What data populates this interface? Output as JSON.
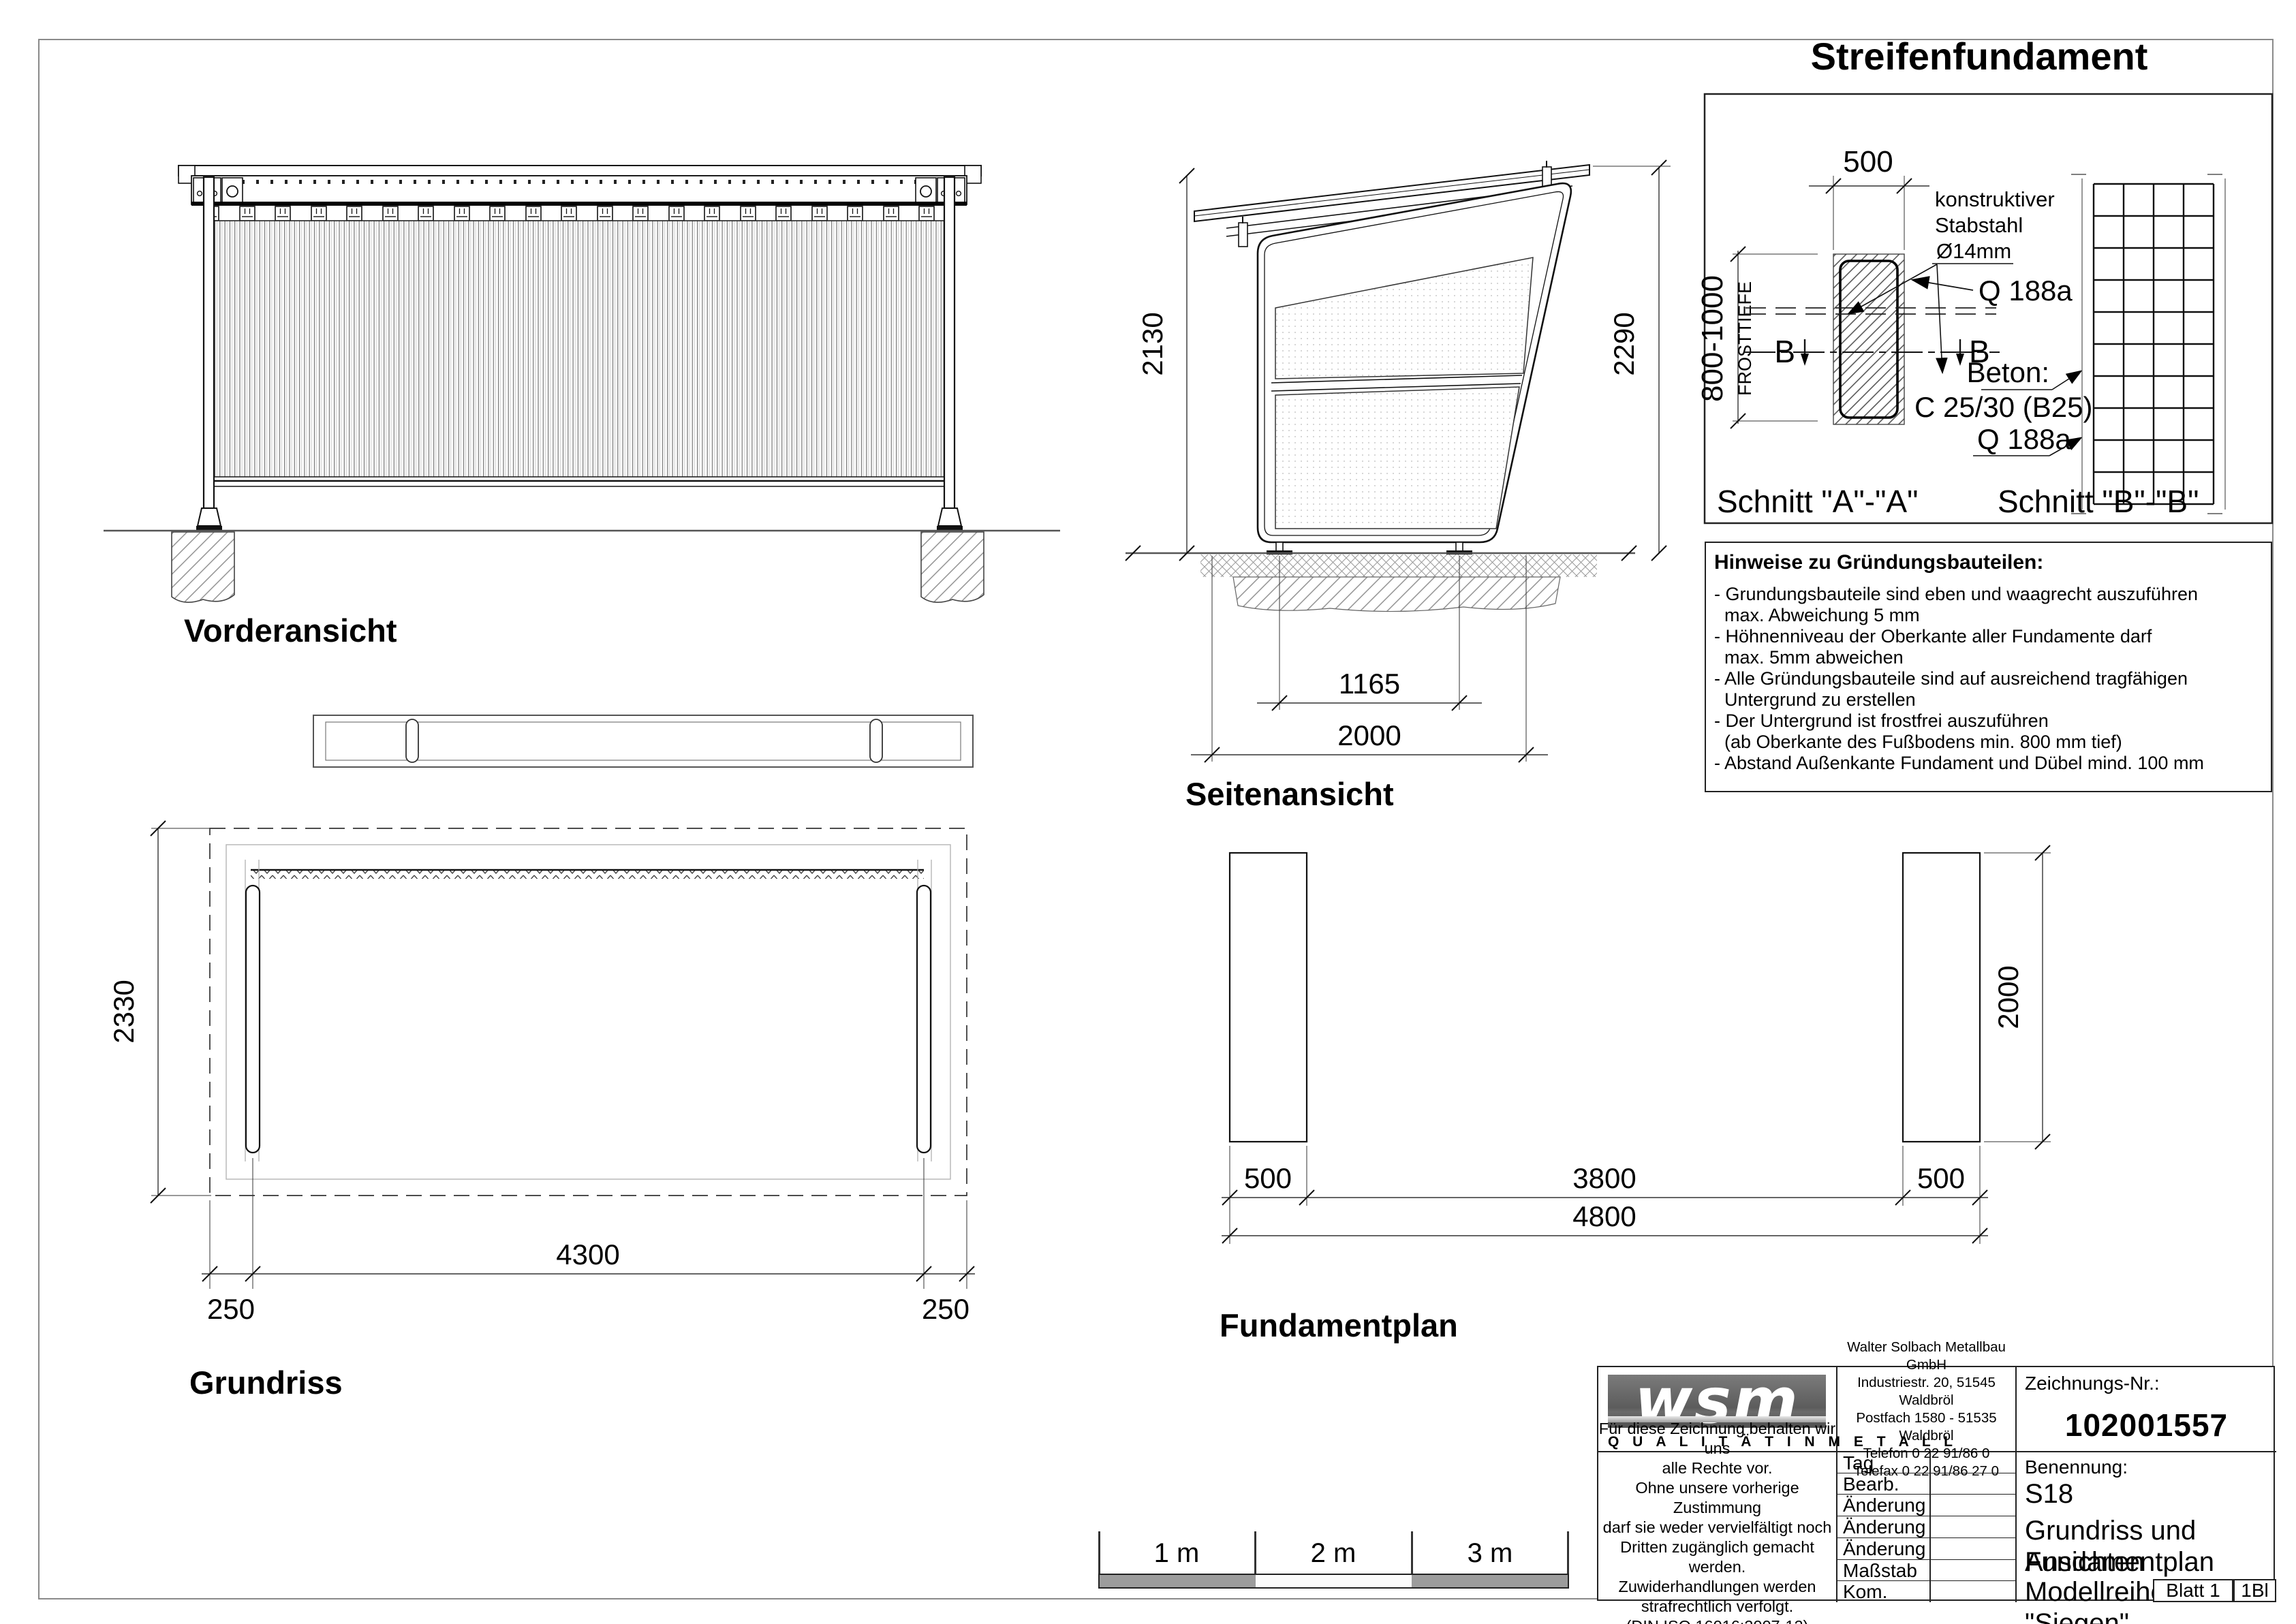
{
  "detail": {
    "title": "Streifenfundament",
    "width_dim": "500",
    "frost_depth": "800-1000",
    "frost_label": "FROSTTIEFE",
    "rebar_line1": "konstruktiver",
    "rebar_line2": "Stabstahl",
    "rebar_line3": "Ø14mm",
    "mesh_top": "Q 188a",
    "beton_label": "Beton:",
    "beton_grade": "C 25/30 (B25)",
    "mesh_bottom": "Q 188a",
    "marker": "B",
    "section_a_label": "Schnitt \"A\"-\"A\"",
    "section_b_label": "Schnitt \"B\"-\"B\""
  },
  "views": {
    "front": {
      "label": "Vorderansicht"
    },
    "side": {
      "label": "Seitenansicht",
      "dim_height_inner": "2130",
      "dim_height_outer": "2290",
      "dim_feet": "1165",
      "dim_width": "2000"
    },
    "plan": {
      "label": "Grundriss",
      "dim_depth": "2330",
      "dim_span": "4300",
      "dim_off_left": "250",
      "dim_off_right": "250"
    },
    "foundation": {
      "label": "Fundamentplan",
      "dim_length": "2000",
      "dim_strip_left": "500",
      "dim_clear": "3800",
      "dim_strip_right": "500",
      "dim_total": "4800"
    }
  },
  "notes": {
    "title": "Hinweise zu Gründungsbauteilen:",
    "lines": [
      "- Grundungsbauteile sind eben und waagrecht auszuführen",
      "  max. Abweichung 5 mm",
      "- Höhnenniveau der Oberkante aller Fundamente darf",
      "  max. 5mm abweichen",
      "- Alle Gründungsbauteile sind auf ausreichend tragfähigen",
      "  Untergrund zu erstellen",
      "- Der Untergrund ist frostfrei auszuführen",
      "  (ab Oberkante des Fußbodens min. 800 mm tief)",
      "- Abstand Außenkante Fundament und Dübel mind. 100 mm"
    ]
  },
  "scale_bar": {
    "seg1": "1 m",
    "seg2": "2 m",
    "seg3": "3 m"
  },
  "title_block": {
    "logo_text": "wsm",
    "logo_tagline": "Q U A L I T Ä T   I N   M E T A L L",
    "company_lines": [
      "Walter Solbach Metallbau GmbH",
      "Industriestr. 20, 51545 Waldbröl",
      "Postfach 1580 - 51535 Waldbröl",
      "Telefon 0 22 91/86 0",
      "Telefax 0 22 91/86 27 0"
    ],
    "drawing_no_label": "Zeichnungs-Nr.:",
    "drawing_no": "102001557",
    "copyright_lines": [
      "Für diese Zeichnung behalten wir uns",
      "alle Rechte vor.",
      "Ohne unsere vorherige Zustimmung",
      "darf sie weder vervielfältigt noch",
      "Dritten zugänglich gemacht werden.",
      "Zuwiderhandlungen  werden",
      "strafrechtlich verfolgt.",
      "(DIN ISO 16016:2007-12)"
    ],
    "rows": [
      {
        "label": "Tag"
      },
      {
        "label": "Bearb."
      },
      {
        "label": "Änderung"
      },
      {
        "label": "Änderung"
      },
      {
        "label": "Änderung"
      },
      {
        "label": "Maßstab"
      },
      {
        "label": "Kom."
      }
    ],
    "name_label": "Benennung:",
    "name_lines": [
      "S18",
      "Grundriss und Ansichten",
      "Fundamentplan",
      "Modellreihe \"Siegen\""
    ],
    "sheet_blatt": "Blatt  1",
    "sheet_count": "1Bl"
  }
}
